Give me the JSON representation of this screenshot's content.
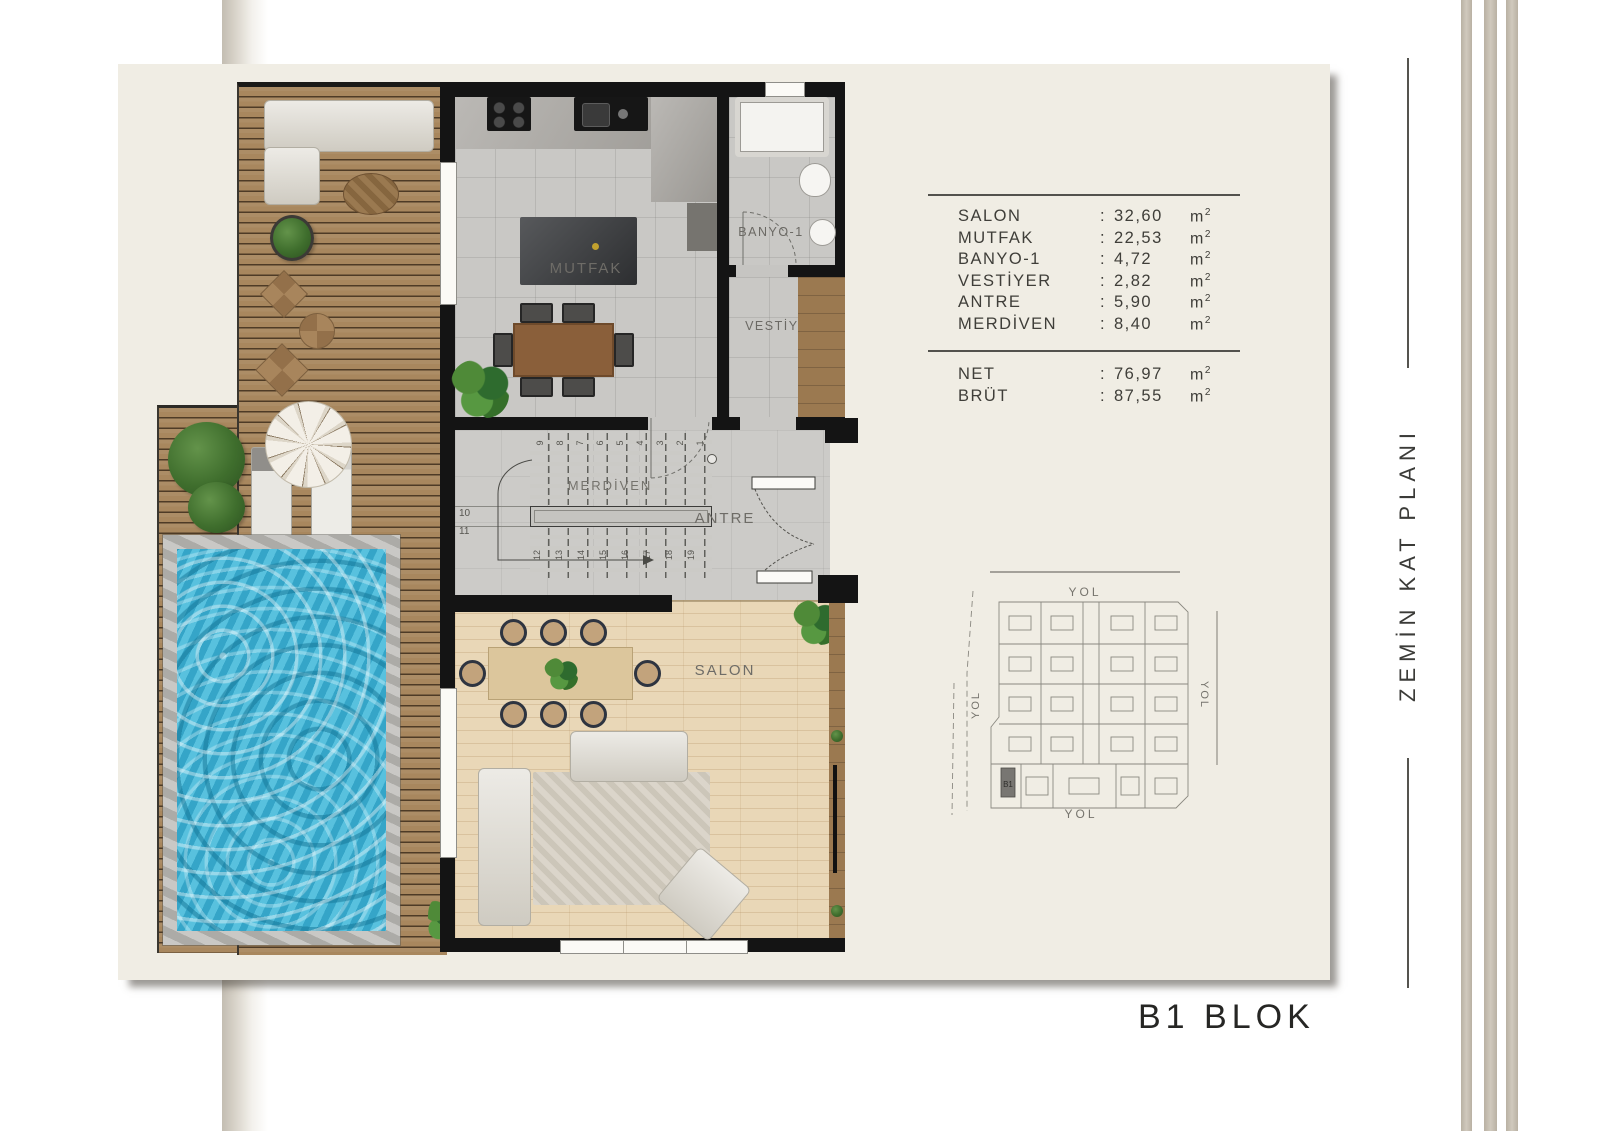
{
  "page": {
    "side_title": "ZEMİN KAT PLANI",
    "block_title": "B1 BLOK"
  },
  "rooms": {
    "mutfak": "MUTFAK",
    "banyo": "BANYO-1",
    "vestiyer": "VESTİYER",
    "merdiven": "MERDİVEN",
    "antre": "ANTRE",
    "salon": "SALON"
  },
  "stairs": {
    "top": [
      "1",
      "2",
      "3",
      "4",
      "5",
      "6",
      "7",
      "8",
      "9"
    ],
    "left": [
      "10",
      "11"
    ],
    "bottom": [
      "12",
      "13",
      "14",
      "15",
      "16",
      "17",
      "18",
      "19"
    ]
  },
  "area_table": {
    "rows": [
      {
        "label": "SALON",
        "sep": ":",
        "value": "32,60",
        "unit": "m",
        "sup": "2"
      },
      {
        "label": "MUTFAK",
        "sep": ":",
        "value": "22,53",
        "unit": "m",
        "sup": "2"
      },
      {
        "label": "BANYO-1",
        "sep": ":",
        "value": "4,72",
        "unit": "m",
        "sup": "2"
      },
      {
        "label": "VESTİYER",
        "sep": ":",
        "value": "2,82",
        "unit": "m",
        "sup": "2"
      },
      {
        "label": "ANTRE",
        "sep": ":",
        "value": "5,90",
        "unit": "m",
        "sup": "2"
      },
      {
        "label": "MERDİVEN",
        "sep": ":",
        "value": "8,40",
        "unit": "m",
        "sup": "2"
      }
    ],
    "totals": [
      {
        "label": "NET",
        "sep": ":",
        "value": "76,97",
        "unit": "m",
        "sup": "2"
      },
      {
        "label": "BRÜT",
        "sep": ":",
        "value": "87,55",
        "unit": "m",
        "sup": "2"
      }
    ]
  },
  "site_plan": {
    "roads": {
      "top": "YOL",
      "left": "YOL",
      "right": "YOL",
      "bottom": "YOL"
    },
    "highlight": "B1"
  },
  "colors": {
    "panel": "#f0ede4",
    "wall": "#141414",
    "deck": "#a8875e",
    "pool_water": "#3fb0d2",
    "salon_floor": "#e9d7b7",
    "tile_floor": "#c9c8c5",
    "text": "#3f3e39"
  }
}
